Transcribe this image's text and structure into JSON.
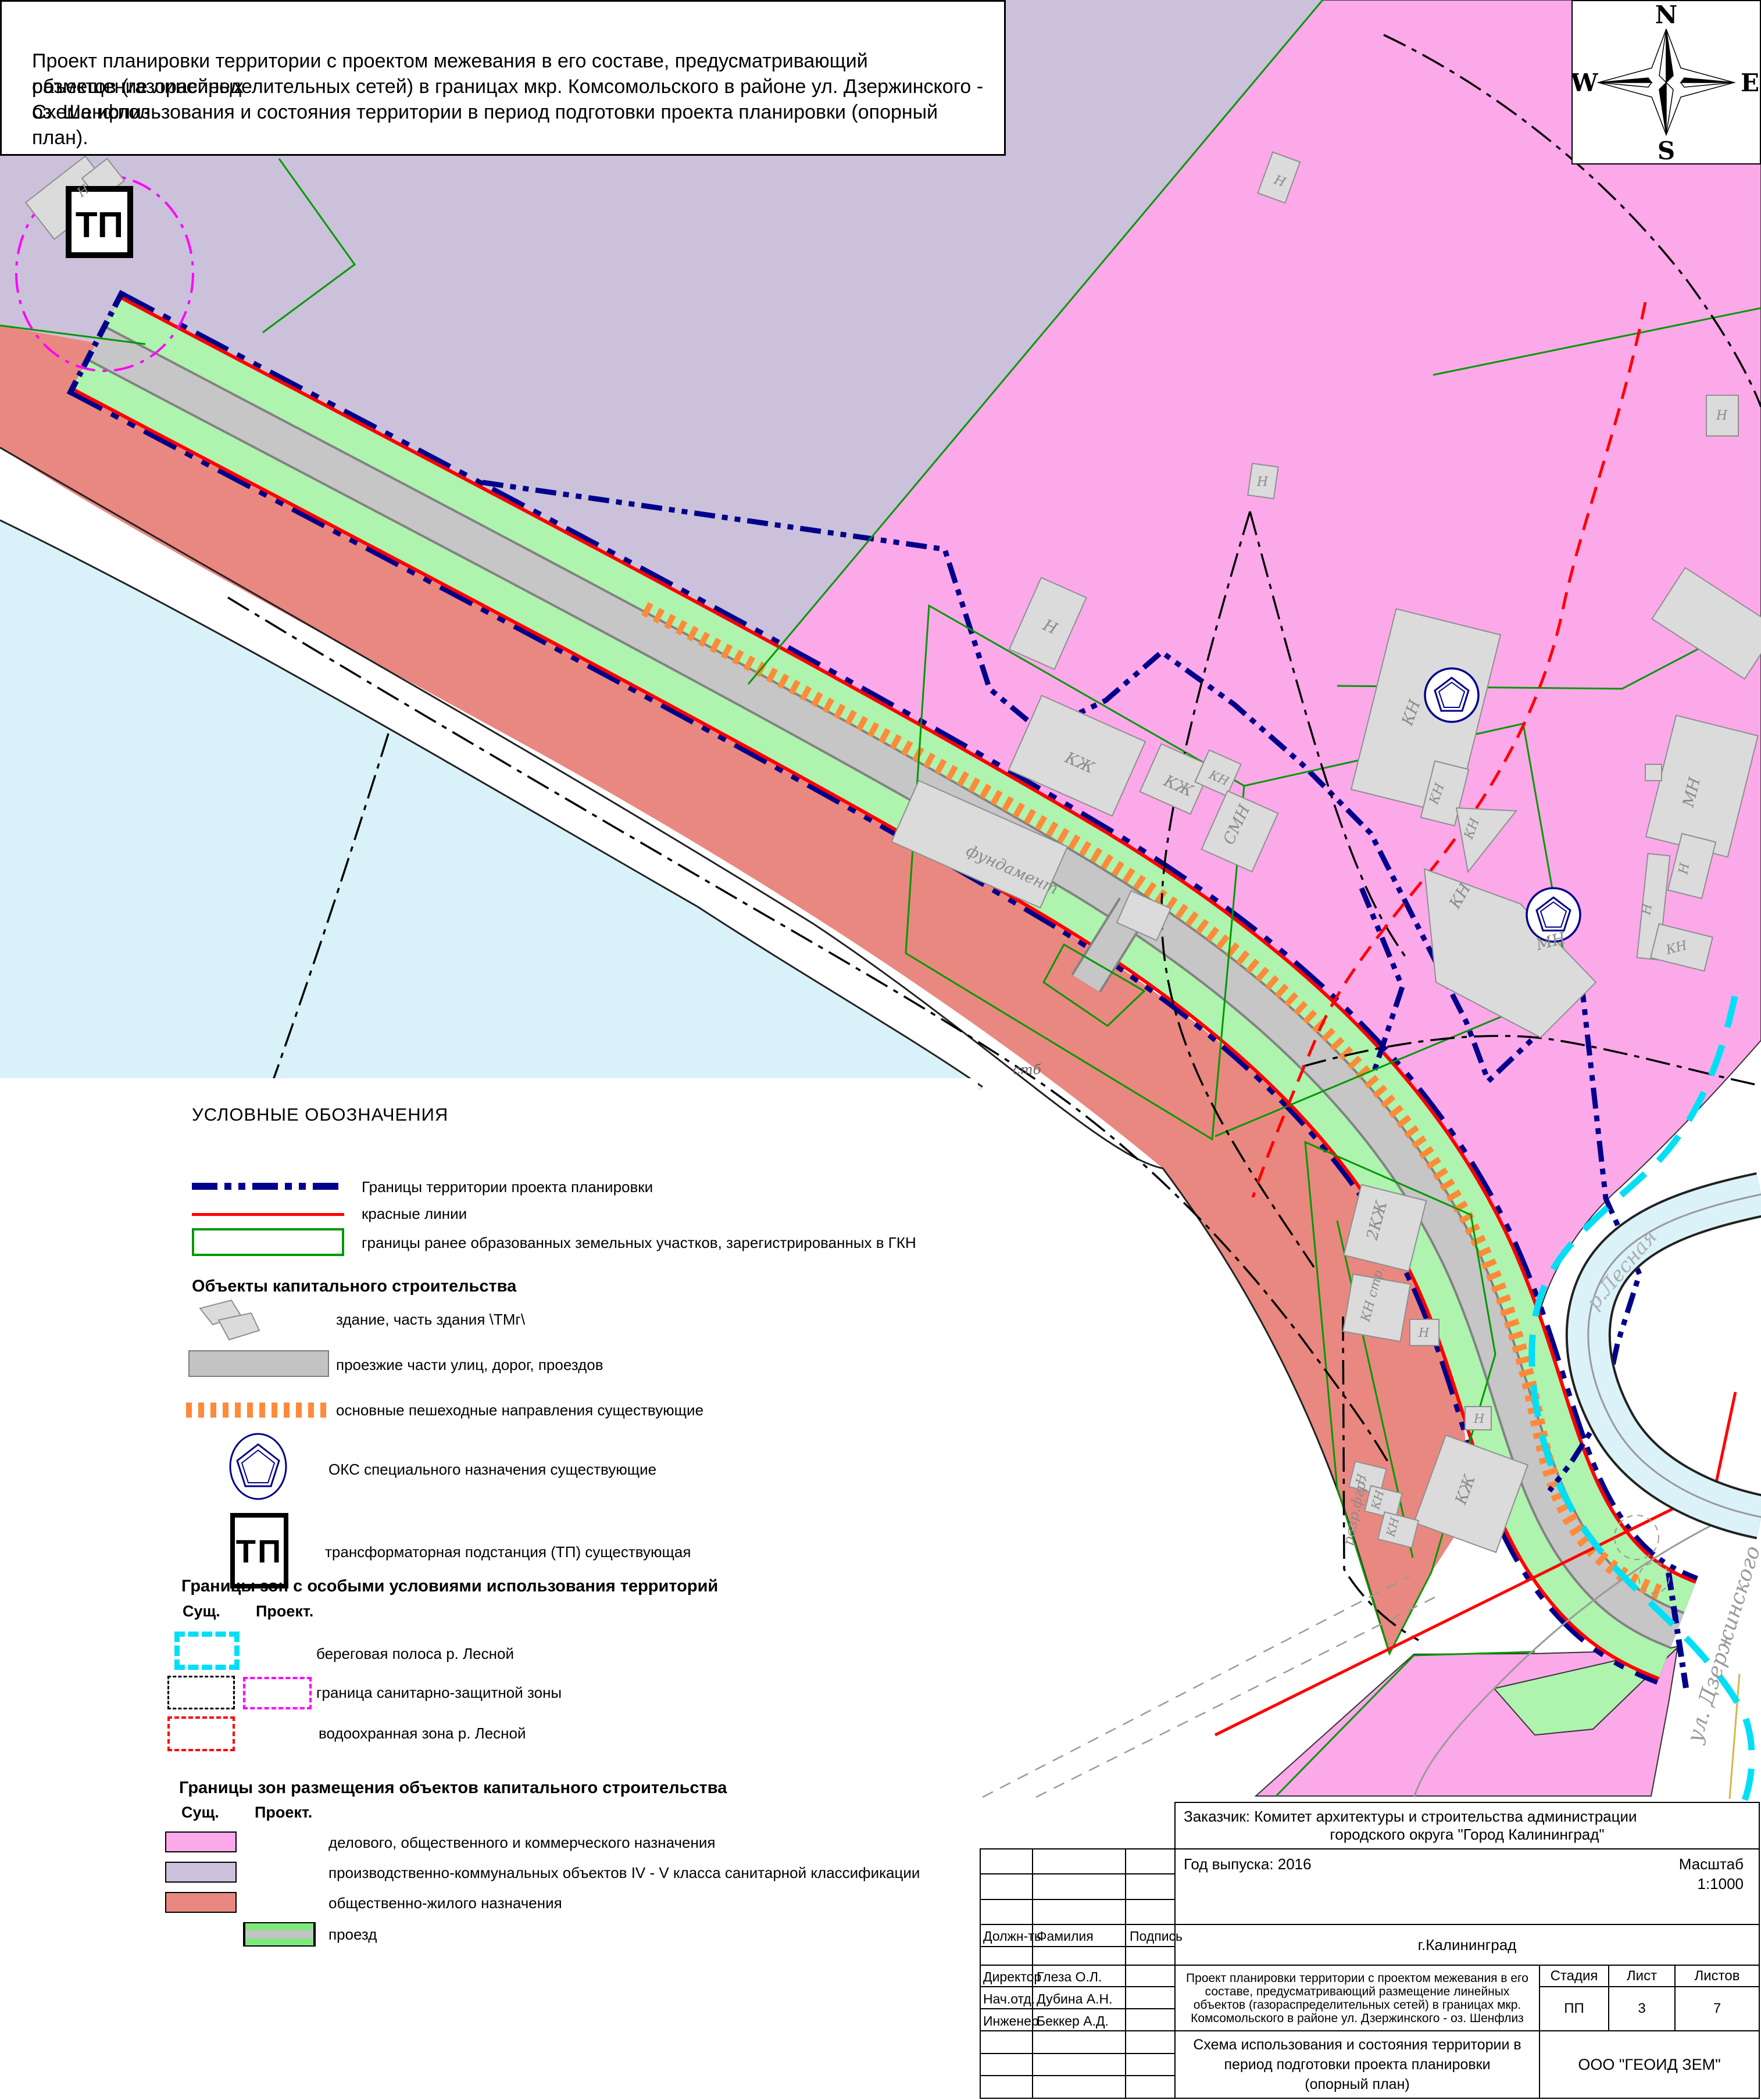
{
  "title": {
    "line1": "Проект планировки территории с проектом межевания в его составе, предусматривающий размещение линейных",
    "line2": "объектов (газораспределительных сетей) в границах мкр. Комсомольского в районе ул. Дзержинского - оз. Шенфлиз.",
    "line3": "Схема использования и состояния территории в период подготовки проекта планировки (опорный план)."
  },
  "compass": {
    "n": "N",
    "s": "S",
    "e": "E",
    "w": "W"
  },
  "legend": {
    "section1": {
      "title": "УСЛОВНЫЕ ОБОЗНАЧЕНИЯ",
      "item1": "Границы территории проекта планировки",
      "item2": "красные линии",
      "item3": "границы ранее образованных земельных участков, зарегистрированных в ГКН"
    },
    "section2": {
      "title": "Объекты капитального строительства",
      "item1": "здание, часть здания \\ТМг\\",
      "item2": "проезжие части улиц, дорог, проездов",
      "item3": "основные пешеходные направления существующие",
      "item4": "ОКС специального назначения существующие",
      "item5": "трансформаторная подстанция (ТП) существующая",
      "tp": "ТП"
    },
    "section3": {
      "title": "Границы зон с особыми условиями использования территорий",
      "col_exist": "Сущ.",
      "col_proj": "Проект.",
      "item1": "береговая полоса р. Лесной",
      "item2": "граница санитарно-защитной зоны",
      "item3": "водоохранная зона р. Лесной"
    },
    "section4": {
      "title": "Границы зон размещения объектов капитального строительства",
      "col_exist": "Сущ.",
      "col_proj": "Проект.",
      "item1": "делового, общественного и коммерческого назначения",
      "item2": "производственно-коммунальных объектов IV - V класса санитарной классификации",
      "item3": "общественно-жилого назначения",
      "item4": "проезд"
    }
  },
  "map": {
    "tp": "ТП",
    "labels": [
      {
        "t": "фундамент"
      },
      {
        "t": "Н"
      },
      {
        "t": "КЖ"
      },
      {
        "t": "КЖ"
      },
      {
        "t": "КН"
      },
      {
        "t": "СМН"
      },
      {
        "t": "КН"
      },
      {
        "t": "КН"
      },
      {
        "t": "КН"
      },
      {
        "t": "КН"
      },
      {
        "t": "МН"
      },
      {
        "t": "МН"
      },
      {
        "t": "Н"
      },
      {
        "t": "Н"
      },
      {
        "t": "КН"
      },
      {
        "t": "Н"
      },
      {
        "t": "Н"
      },
      {
        "t": "Н"
      },
      {
        "t": "2КЖ"
      },
      {
        "t": "КН стр."
      },
      {
        "t": "Н"
      },
      {
        "t": "КЖ"
      },
      {
        "t": "Н"
      },
      {
        "t": "Н"
      },
      {
        "t": "КН"
      },
      {
        "t": "КН"
      },
      {
        "t": "разр.фгр."
      },
      {
        "t": "Н"
      },
      {
        "t": "стб"
      },
      {
        "t": "р.Лесная"
      },
      {
        "t": "ул. Дзержинского"
      }
    ]
  },
  "stamp": {
    "customer1": "Заказчик: Комитет архитектуры и строительства администрации",
    "customer2": "городского округа \"Город Калининград\"",
    "year": "Год выпуска: 2016",
    "scale_label": "Масштаб",
    "scale_value": "1:1000",
    "city": "г.Калининград",
    "col_position": "Должн-ть",
    "col_surname": "Фамилия",
    "col_sign": "Подпись",
    "people": [
      {
        "position": "Директор",
        "name": "Глеза О.Л."
      },
      {
        "position": "Нач.отд.",
        "name": "Дубина А.Н."
      },
      {
        "position": "Инженер",
        "name": "Беккер А.Д."
      }
    ],
    "project_title": "Проект планировки территории с проектом межевания в его составе, предусматривающий размещение линейных объектов (газораспределительных сетей) в границах мкр. Комсомольского в районе ул. Дзержинского - оз. Шенфлиз",
    "stage_label": "Стадия",
    "sheet_label": "Лист",
    "sheets_label": "Листов",
    "stage": "ПП",
    "sheet": "3",
    "sheets": "7",
    "scheme_title": "Схема использования и состояния территории в период подготовки проекта планировки (опорный план)",
    "company": "ООО \"ГЕОИД ЗЕМ\""
  }
}
